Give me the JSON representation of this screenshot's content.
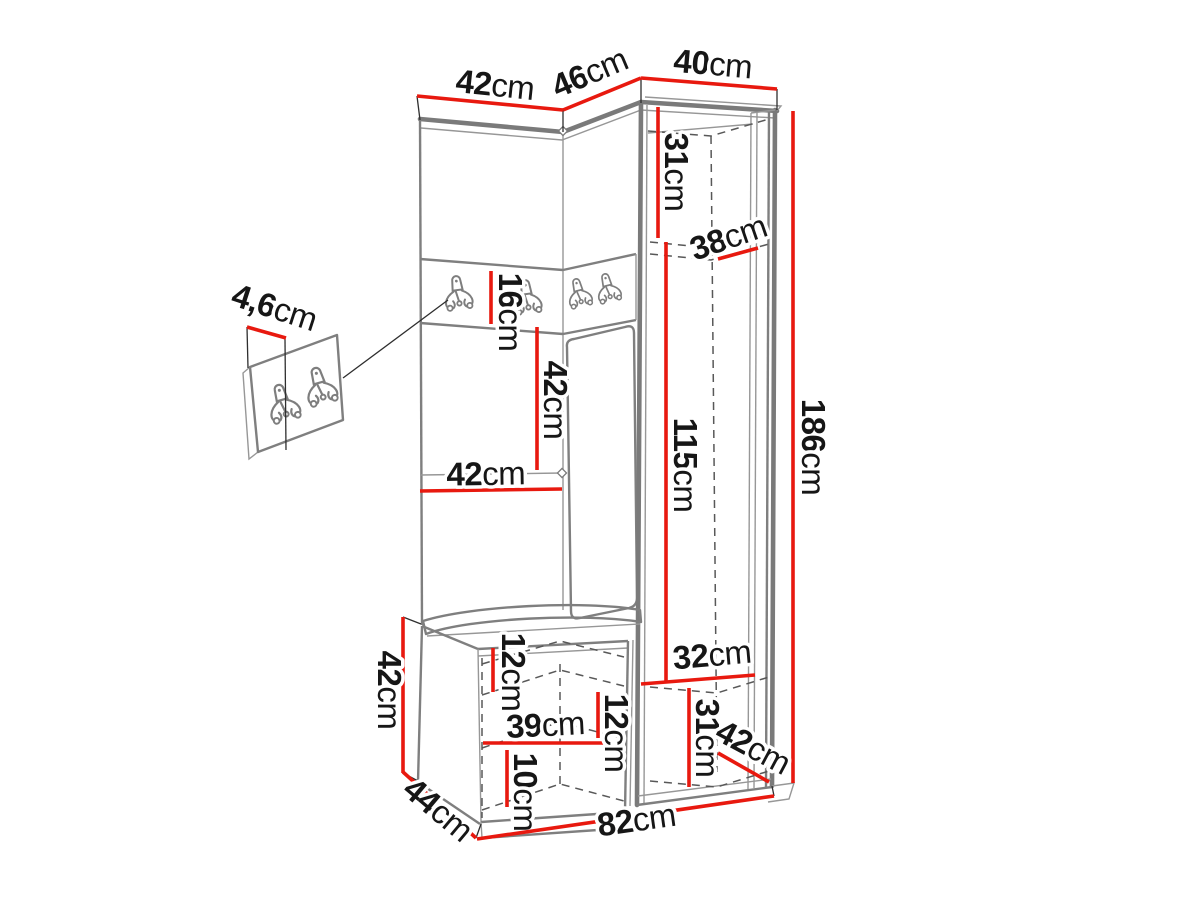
{
  "diagram": {
    "subject": "corner hallway wardrobe set with hook rail, bench and wall hook panel",
    "style": "technical dimension drawing",
    "unit": "cm",
    "colors": {
      "dimension_line": "#e8190f",
      "furniture_outline": "#7a7a7a",
      "label_text": "#161616",
      "background": "#ffffff"
    }
  },
  "labels": {
    "top_left_width": {
      "v": "42",
      "u": "cm"
    },
    "top_middle_width": {
      "v": "46",
      "u": "cm"
    },
    "top_right_width": {
      "v": "40",
      "u": "cm"
    },
    "top_compartment_height": {
      "v": "31",
      "u": "cm"
    },
    "top_shelf_depth": {
      "v": "38",
      "u": "cm"
    },
    "total_height": {
      "v": "186",
      "u": "cm"
    },
    "hook_rail_height": {
      "v": "16",
      "u": "cm"
    },
    "middle_panel_height": {
      "v": "42",
      "u": "cm"
    },
    "panel_width": {
      "v": "42",
      "u": "cm"
    },
    "hanging_space_height": {
      "v": "115",
      "u": "cm"
    },
    "hook_panel_thickness": {
      "v": "4,6",
      "u": "cm"
    },
    "bench_height": {
      "v": "42",
      "u": "cm"
    },
    "bench_inner_top": {
      "v": "12",
      "u": "cm"
    },
    "bench_shelf_width": {
      "v": "39",
      "u": "cm"
    },
    "bench_inner_middle": {
      "v": "12",
      "u": "cm"
    },
    "bench_inner_bottom": {
      "v": "10",
      "u": "cm"
    },
    "bottom_shelf_width": {
      "v": "32",
      "u": "cm"
    },
    "bottom_compartment_height": {
      "v": "31",
      "u": "cm"
    },
    "bottom_shelf_depth": {
      "v": "42",
      "u": "cm"
    },
    "bench_depth": {
      "v": "44",
      "u": "cm"
    },
    "total_width": {
      "v": "82",
      "u": "cm"
    }
  }
}
